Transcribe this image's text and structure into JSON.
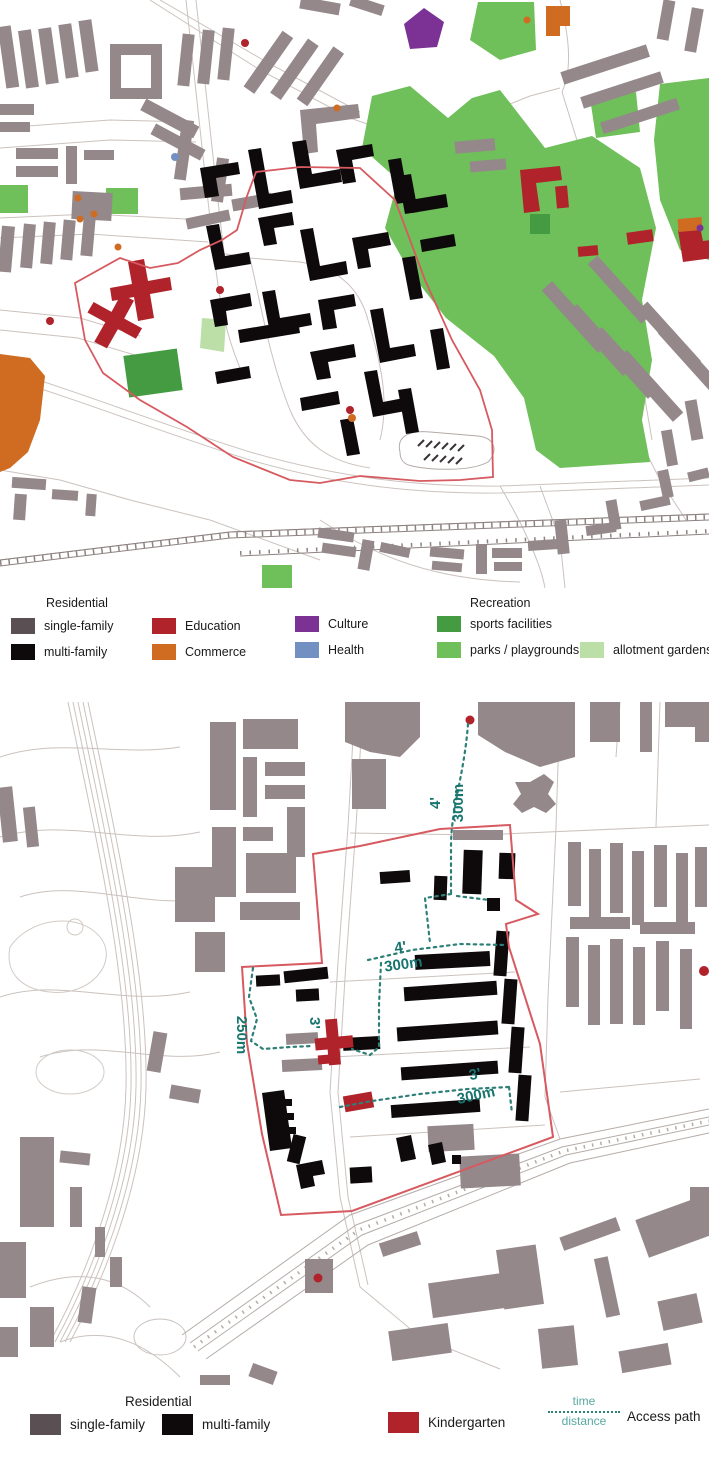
{
  "colors": {
    "single_family_legend": "#5a4f52",
    "single_family_map": "#94888b",
    "multi_family": "#0e0a0c",
    "education": "#b0232a",
    "commerce": "#d06c22",
    "culture": "#7b3294",
    "health": "#7291c2",
    "sports": "#449b42",
    "parks": "#6fbf5a",
    "allotment": "#bcdfa8",
    "kindergarten": "#b0232a",
    "boundary": "#d65a60",
    "access_path": "#2e7f78",
    "annotation_text": "#17756e",
    "legend_teal": "#58a9a2"
  },
  "legend_top": {
    "residential_header": "Residential",
    "recreation_header": "Recreation",
    "single_family": "single-family",
    "multi_family": "multi-family",
    "education": "Education",
    "commerce": "Commerce",
    "culture": "Culture",
    "health": "Health",
    "sports": "sports facilities",
    "parks": "parks / playgrounds",
    "allotment": "allotment gardens"
  },
  "legend_bottom": {
    "residential_header": "Residential",
    "single_family": "single-family",
    "multi_family": "multi-family",
    "kindergarten": "Kindergarten",
    "time_label": "time",
    "distance_label": "distance",
    "access_path": "Access path"
  },
  "annotations": {
    "north": {
      "time": "4'",
      "distance": "300m"
    },
    "mid": {
      "time": "4'",
      "distance": "300m"
    },
    "west": {
      "time": "3'",
      "distance": "250m"
    },
    "southeast": {
      "time": "3'",
      "distance": "300m"
    }
  }
}
